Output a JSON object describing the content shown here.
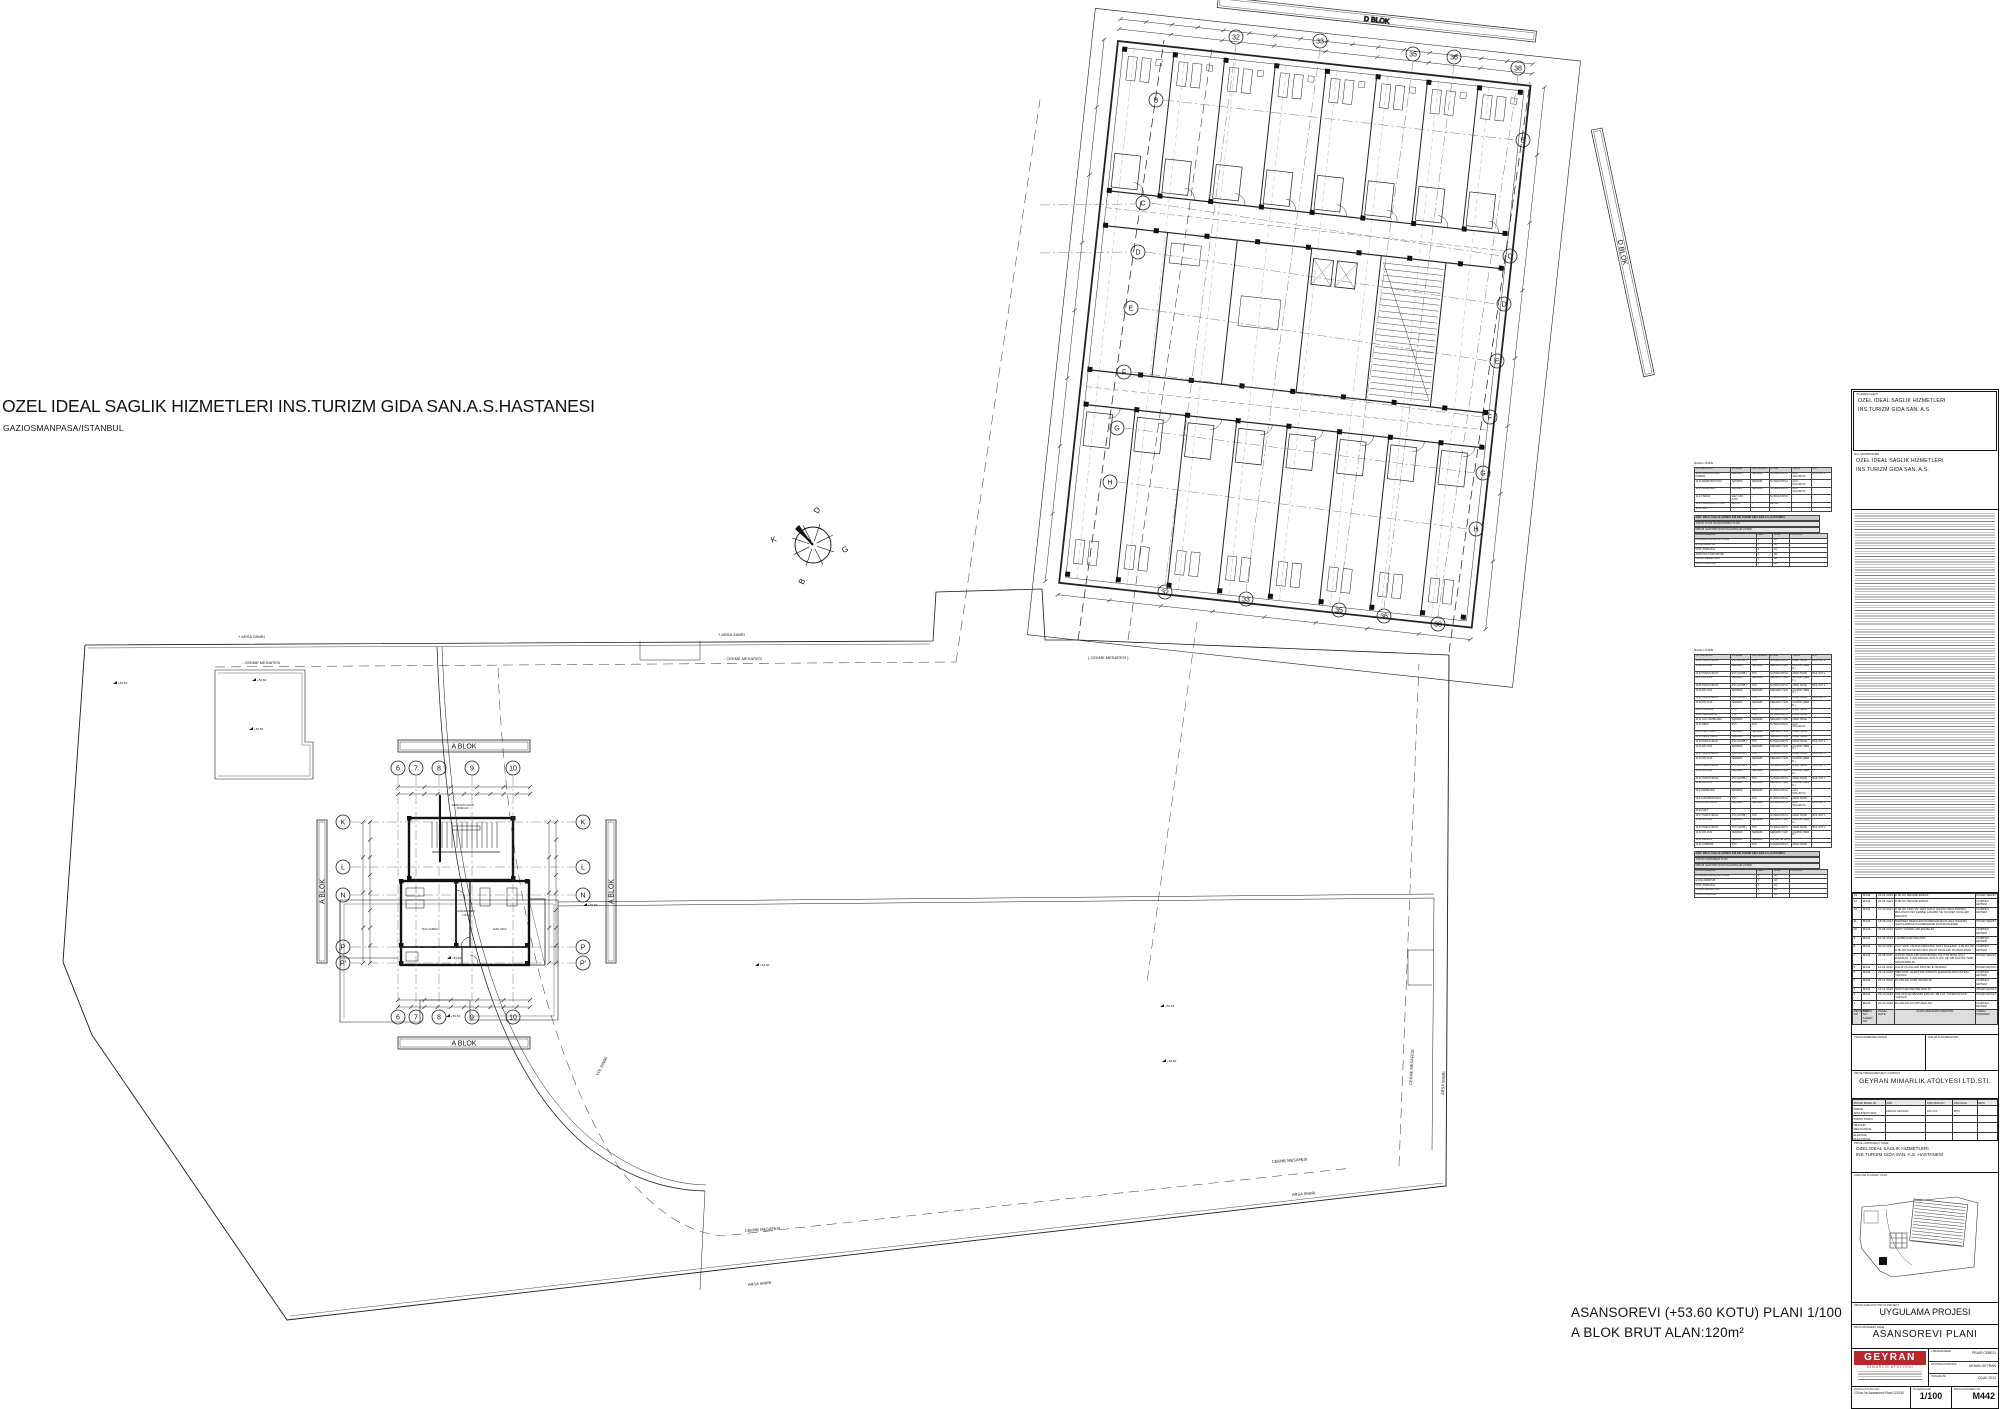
{
  "header": {
    "title": "OZEL IDEAL SAGLIK HIZMETLERI INS.TURIZM GIDA SAN.A.S.HASTANESI",
    "subtitle": "GAZIOSMANPASA/ISTANBUL"
  },
  "caption": {
    "line1": "ASANSOREVI (+53.60 KOTU) PLANI 1/100",
    "line2": "A BLOK BRUT ALAN:120m²"
  },
  "compass": {
    "top": "D",
    "left": "K",
    "right": "G",
    "bottom": "B"
  },
  "site_labels": [
    {
      "t": "+ ARSA SINIRI",
      "x": 238,
      "y": 638,
      "r": 0,
      "s": 4
    },
    {
      "t": "+ ARSA SINIRI",
      "x": 718,
      "y": 636,
      "r": 0,
      "s": 4
    },
    {
      "t": "- CEKME MESAFESI",
      "x": 242,
      "y": 664,
      "r": 0,
      "s": 4
    },
    {
      "t": "- CEKME MESAFESI",
      "x": 724,
      "y": 660,
      "r": 0,
      "s": 4
    },
    {
      "t": "( CEKME MESAFESI )",
      "x": 1088,
      "y": 659,
      "r": 0,
      "s": 4
    },
    {
      "t": "CEKME MESAFESI",
      "x": 745,
      "y": 1232,
      "r": -4,
      "s": 4
    },
    {
      "t": "ARSA SINIRI",
      "x": 748,
      "y": 1286,
      "r": -5,
      "s": 4
    },
    {
      "t": "CEKME MESAFESI",
      "x": 1272,
      "y": 1163,
      "r": -4,
      "s": 4
    },
    {
      "t": "ARSA SINIRI",
      "x": 1292,
      "y": 1196,
      "r": -4,
      "s": 4
    },
    {
      "t": "ARSA SINIRI",
      "x": 1444,
      "y": 1095,
      "r": -87,
      "s": 4
    },
    {
      "t": "CEKME MESAFESI",
      "x": 1412,
      "y": 1085,
      "r": -87,
      "s": 4
    },
    {
      "t": "YOL SINIRI",
      "x": 598,
      "y": 1076,
      "r": -62,
      "s": 4
    }
  ],
  "spot_value": "+53.60",
  "spots": [
    {
      "x": 113,
      "y": 684
    },
    {
      "x": 252,
      "y": 681
    },
    {
      "x": 249,
      "y": 730
    },
    {
      "x": 447,
      "y": 959
    },
    {
      "x": 446,
      "y": 1017
    },
    {
      "x": 583,
      "y": 906
    },
    {
      "x": 755,
      "y": 966
    },
    {
      "x": 1160,
      "y": 1007
    },
    {
      "x": 1162,
      "y": 1062
    }
  ],
  "a_block": {
    "bar_label": "A BLOK",
    "cols": {
      "labels": [
        "6",
        "7",
        "8",
        "9",
        "10"
      ],
      "x": [
        398,
        416,
        439,
        472,
        513
      ]
    },
    "rows": {
      "labels": [
        "K",
        "L",
        "N",
        "P",
        "P'"
      ],
      "y": [
        822,
        867,
        895,
        947,
        963
      ]
    },
    "top_y": 768,
    "bottom_y": 1017,
    "left_x": 343,
    "right_x": 583,
    "texts": [
      {
        "t": "MERDIVEN KOVASI",
        "x": 463,
        "y": 806,
        "s": 2.4
      },
      {
        "t": "BOSLUGU",
        "x": 463,
        "y": 809,
        "s": 2.4
      },
      {
        "t": "ASANSOREVI",
        "x": 466,
        "y": 912,
        "s": 2.8
      },
      {
        "t": "+53.60",
        "x": 466,
        "y": 916,
        "s": 2.5
      },
      {
        "t": "MAK. DAIRESI",
        "x": 430,
        "y": 930,
        "s": 2.3
      },
      {
        "t": "ELEK. PANO",
        "x": 500,
        "y": 930,
        "s": 2.3
      }
    ]
  },
  "d_block": {
    "bar_label": "D BLOK",
    "top": [
      {
        "t": "32",
        "x": 1236,
        "y": 37
      },
      {
        "t": "33",
        "x": 1320,
        "y": 41
      },
      {
        "t": "35",
        "x": 1413,
        "y": 54
      },
      {
        "t": "36",
        "x": 1454,
        "y": 57
      },
      {
        "t": "38",
        "x": 1518,
        "y": 68
      }
    ],
    "bottom": [
      {
        "t": "32",
        "x": 1165,
        "y": 592
      },
      {
        "t": "33",
        "x": 1246,
        "y": 599
      },
      {
        "t": "35",
        "x": 1339,
        "y": 610
      },
      {
        "t": "36",
        "x": 1384,
        "y": 616
      },
      {
        "t": "38",
        "x": 1438,
        "y": 624
      }
    ],
    "left": [
      {
        "t": "B",
        "x": 1156,
        "y": 100
      },
      {
        "t": "C",
        "x": 1143,
        "y": 203
      },
      {
        "t": "D",
        "x": 1138,
        "y": 252
      },
      {
        "t": "E",
        "x": 1131,
        "y": 308
      },
      {
        "t": "F",
        "x": 1124,
        "y": 372
      },
      {
        "t": "G",
        "x": 1117,
        "y": 428
      },
      {
        "t": "H",
        "x": 1110,
        "y": 482
      }
    ],
    "right": [
      {
        "t": "B",
        "x": 1523,
        "y": 140
      },
      {
        "t": "C",
        "x": 1510,
        "y": 256
      },
      {
        "t": "D",
        "x": 1504,
        "y": 304
      },
      {
        "t": "E",
        "x": 1497,
        "y": 361
      },
      {
        "t": "F",
        "x": 1490,
        "y": 417
      },
      {
        "t": "G",
        "x": 1483,
        "y": 473
      },
      {
        "t": "H",
        "x": 1476,
        "y": 529
      }
    ]
  },
  "tables": {
    "mahal_title": "MAHAL LISTESI",
    "mahal_cols": [
      "NO  MAHAL ADI",
      "DOSEME",
      "SUPURGELIK",
      "DUVAR",
      "TAVAN",
      "NOT"
    ],
    "mahal1_rows": [
      [
        "14.01 ASANSOR MAK. DAIRESI",
        "SERAMIK",
        "SERAMIK",
        "SU BAZLI BOYA",
        "ALCI SIVA+BOYA",
        "BKZ. NOT 2"
      ],
      [
        "14.02 MERDIVEN HOLU",
        "SERAMIK",
        "SERAMIK",
        "SU BAZLI BOYA",
        "ALCI SIVA+BOYA",
        "-"
      ],
      [
        "14.03 MERDIVEN",
        "SERAMIK",
        "SERAMIK",
        "SU BAZLI BOYA",
        "ALCI SIVA+BOYA",
        "-"
      ],
      [
        "14.04 TERAS",
        "GEZ. CATI KAPL.",
        "-",
        "SU BAZLI BOYA",
        "-",
        "-"
      ],
      [
        "14.05 ASANSOR KUYUSU",
        "BETON",
        "-",
        "BETON",
        "-",
        "-"
      ],
      [
        "14.06 SAFT",
        "-",
        "-",
        "-",
        "-",
        "-"
      ]
    ],
    "block1": {
      "line1": "OZEL IDEAL SAGLIK HIZMETLERI INS.TURIZM GIDA SAN.A.S. HASTANESI",
      "line2": "A BLOK 13.KAT VE ASANSOREVI PLANI",
      "line3": "MIMARI, ELEKTRIK DONATI ELEMANLARI LISTESI",
      "cols": [
        "DONATI ELEMANI",
        "ADET",
        "BIRIM",
        "ACIKLAMA"
      ],
      "rows": [
        [
          "FLORESAN ARMATUR 2X36W",
          "8",
          "AD",
          ""
        ],
        [
          "ETANJ ARMATUR",
          "4",
          "AD",
          ""
        ],
        [
          "PRIZ (TOPRAKLI)",
          "6",
          "AD",
          ""
        ],
        [
          "ANAHTAR (KOMUTATOR)",
          "4",
          "AD",
          ""
        ],
        [
          "DUMAN DEDEKTORU",
          "3",
          "AD",
          ""
        ],
        [
          "ACIL AYDINLATMA",
          "2",
          "AD",
          ""
        ]
      ]
    },
    "mahal2_rows": [
      [
        "13.01 HASTA ODASI",
        "PVC (ANTIB.)",
        "PVC",
        "SU BAZLI BOYA",
        "ASMA TAVAN",
        "BKZ. NOT 1"
      ],
      [
        "13.02 WC-DUS",
        "SERAMIK",
        "SERAMIK",
        "SERAMIK H:220",
        "ALCIPAN (NEM D.)",
        "-"
      ],
      [
        "13.03 HASTA ODASI",
        "PVC (ANTIB.)",
        "PVC",
        "SU BAZLI BOYA",
        "ASMA TAVAN",
        "BKZ. NOT 1"
      ],
      [
        "13.04 WC-DUS",
        "SERAMIK",
        "SERAMIK",
        "SERAMIK H:220",
        "ALCIPAN (NEM D.)",
        "-"
      ],
      [
        "13.05 HASTA ODASI",
        "PVC (ANTIB.)",
        "PVC",
        "SU BAZLI BOYA",
        "ASMA TAVAN",
        "BKZ. NOT 1"
      ],
      [
        "13.06 WC-DUS",
        "SERAMIK",
        "SERAMIK",
        "SERAMIK H:220",
        "ALCIPAN (NEM D.)",
        "-"
      ],
      [
        "13.07 HASTA ODASI",
        "PVC (ANTIB.)",
        "PVC",
        "SU BAZLI BOYA",
        "ASMA TAVAN",
        "BKZ. NOT 1"
      ],
      [
        "13.08 WC-DUS",
        "SERAMIK",
        "SERAMIK",
        "SERAMIK H:220",
        "ALCIPAN (NEM D.)",
        "-"
      ],
      [
        "13.09 KORIDOR",
        "PVC",
        "PVC",
        "SU BAZLI BOYA",
        "ASMA TAVAN",
        "-"
      ],
      [
        "13.10 HEMSIRE IST.",
        "PVC",
        "PVC",
        "SU BAZLI BOYA",
        "ASMA TAVAN",
        "-"
      ],
      [
        "13.11 ILAC HAZIRLAMA",
        "SERAMIK",
        "SERAMIK",
        "SERAMIK H:150",
        "ASMA TAVAN",
        "-"
      ],
      [
        "13.12 DEPO",
        "PVC",
        "PVC",
        "SU BAZLI BOYA",
        "ALCI SIVA+BOYA",
        "-"
      ],
      [
        "13.13 KIRLI ODASI",
        "SERAMIK",
        "SERAMIK",
        "SERAMIK H:220",
        "ASMA TAVAN",
        "-"
      ],
      [
        "13.14 TEMIZ ODASI",
        "SERAMIK",
        "SERAMIK",
        "SERAMIK H:220",
        "ASMA TAVAN",
        "-"
      ],
      [
        "13.15 HASTA ODASI",
        "PVC (ANTIB.)",
        "PVC",
        "SU BAZLI BOYA",
        "ASMA TAVAN",
        "BKZ. NOT 1"
      ],
      [
        "13.16 WC-DUS",
        "SERAMIK",
        "SERAMIK",
        "SERAMIK H:220",
        "ALCIPAN (NEM D.)",
        "-"
      ],
      [
        "13.17 HASTA ODASI",
        "PVC (ANTIB.)",
        "PVC",
        "SU BAZLI BOYA",
        "ASMA TAVAN",
        "BKZ. NOT 1"
      ],
      [
        "13.18 WC-DUS",
        "SERAMIK",
        "SERAMIK",
        "SERAMIK H:220",
        "ALCIPAN (NEM D.)",
        "-"
      ],
      [
        "13.19 HASTA ODASI",
        "PVC (ANTIB.)",
        "PVC",
        "SU BAZLI BOYA",
        "ASMA TAVAN",
        "BKZ. NOT 1"
      ],
      [
        "13.20 WC-DUS",
        "SERAMIK",
        "SERAMIK",
        "SERAMIK H:220",
        "ALCIPAN (NEM D.)",
        "-"
      ],
      [
        "13.21 HASTA ODASI",
        "PVC (ANTIB.)",
        "PVC",
        "SU BAZLI BOYA",
        "ASMA TAVAN",
        "BKZ. NOT 1"
      ],
      [
        "13.22 WC-DUS",
        "SERAMIK",
        "SERAMIK",
        "SERAMIK H:220",
        "ALCIPAN (NEM D.)",
        "-"
      ],
      [
        "13.23 MERDIVEN",
        "SERAMIK",
        "SERAMIK",
        "SU BAZLI BOYA",
        "ALCI SIVA+BOYA",
        "-"
      ],
      [
        "13.24 ASANSOR HOLU",
        "PVC",
        "PVC",
        "SU BAZLI BOYA",
        "ASMA TAVAN",
        "-"
      ],
      [
        "13.25 PANO ODASI",
        "SERAMIK",
        "SERAMIK",
        "SU BAZLI BOYA",
        "ALCI SIVA+BOYA",
        "BKZ. NOT 2"
      ],
      [
        "13.26 SAFT",
        "-",
        "-",
        "-",
        "-",
        "-"
      ],
      [
        "13.27 HASTA ODASI",
        "PVC (ANTIB.)",
        "PVC",
        "SU BAZLI BOYA",
        "ASMA TAVAN",
        "BKZ. NOT 1"
      ],
      [
        "13.28 WC-DUS",
        "SERAMIK",
        "SERAMIK",
        "SERAMIK H:220",
        "ALCIPAN (NEM D.)",
        "-"
      ],
      [
        "13.29 HASTA ODASI",
        "PVC (ANTIB.)",
        "PVC",
        "SU BAZLI BOYA",
        "ASMA TAVAN",
        "BKZ. NOT 1"
      ],
      [
        "13.30 WC-DUS",
        "SERAMIK",
        "SERAMIK",
        "SERAMIK H:220",
        "ALCIPAN (NEM D.)",
        "-"
      ],
      [
        "13.31 BALKON",
        "SERAMIK",
        "SERAMIK",
        "DIS CEPHE BOYA",
        "-",
        "-"
      ],
      [
        "13.32 KORIDOR",
        "PVC",
        "PVC",
        "SU BAZLI BOYA",
        "ASMA TAVAN",
        "-"
      ]
    ],
    "block2": {
      "line1": "OZEL IDEAL SAGLIK HIZMETLERI INS.TURIZM GIDA SAN.A.S. HASTANESI",
      "line2": "A BLOK ASANSOREVI PLANI",
      "line3": "MIMARI, ELEKTRIK DONATI ELEMANLARI LISTESI",
      "cols": [
        "DONATI ELEMANI",
        "ADET",
        "BIRIM",
        "ACIKLAMA"
      ],
      "rows": [
        [
          "FLORESAN ARMATUR 1X36W",
          "6",
          "AD",
          ""
        ],
        [
          "ETANJ ARMATUR",
          "3",
          "AD",
          ""
        ],
        [
          "PRIZ (TOPRAKLI)",
          "4",
          "AD",
          ""
        ],
        [
          "DUMAN DEDEKTORU",
          "2",
          "AD",
          ""
        ],
        [
          "ACIL AYDINLATMA",
          "2",
          "AD",
          ""
        ]
      ]
    }
  },
  "titleblock": {
    "client_label": "IS VEREN/CLIENT",
    "client_line1": "OZEL IDEAL SAGLIK HIZMETLERI",
    "client_line2": "INS.TURIZM GIDA SAN. A.S.",
    "owner_label": "MAL SAHIBI/OWNER",
    "owner_line1": "OZEL IDEAL SAGLIK HIZMETLERI",
    "owner_line2": "INS.TURIZM GIDA SAN. A.S.",
    "revision": {
      "headers": [
        "REVIZYON NO",
        "PAFTA NO. SHEET NO",
        "TARIH DATE",
        "ACIKLAMA EXPLANATION",
        "CIZEN DRAWER"
      ],
      "rows": [
        [
          "14",
          "M442",
          "24.01.2013",
          "D BLOK REVIZE EDILDI.",
          "PINAR SERIN"
        ],
        [
          "13",
          "M442",
          "24.01.2013",
          "D BLOK REVIZE EDILDI.",
          "NURTEN ERTEM"
        ],
        [
          "12",
          "M442",
          "17.10.2012",
          "D BLOK 1302 VE 1303 NOLU HASTA ODALARINDA BULUNAN WC'LERDE LAVABO VE KLOZET AKSLARI DEGISTI.",
          "NURTEN ERTEM"
        ],
        [
          "11",
          "M442",
          "18.09.2012",
          "DEPREM DERZLERI DUZENLENDI PLANA ISLENDI. SAFTLARDAKI DUZENLEME PLANA ISLENDI.",
          "PINAR SERIN"
        ],
        [
          "10",
          "M442",
          "24.05.2012",
          "SAFT KAPAKLARI DUZELDI.",
          "NURTEN ERTEM"
        ],
        [
          "9",
          "M442",
          "10.04.2012",
          "LAVABOLAR DEGISTI.",
          "NURTEN ERTEM"
        ],
        [
          "8",
          "M442",
          "20.12.2011",
          "22-P AKSI YANINA MEKANIK SAFT EKLENDI. A BLOK VE D BLOKTAKI ELEKTRIK PANO ODALARI DUZENLENDI.",
          "NURTEN ERTEM"
        ],
        [
          "7",
          "M442",
          "24.08.2011",
          "HASTA ODALARI DUVARINDA YALITIM BOSLUGU DARALDI. 1.220 MAHAL NO'LU WC VE DB SAFTIN YERI DEGISTIRILDI.",
          "PINAR SERIN"
        ],
        [
          "6",
          "M442",
          "10.01.2011",
          "KALIP PLANLARI PROJEYE ISLENDI.",
          "PINAR EKINCI"
        ],
        [
          "5",
          "M442",
          "23.12.2010",
          "MEKANIK, ELEKTRIK DONATI ELEMANLARI LISTESI YAPILDI.",
          "NURTEN ERTEM"
        ],
        [
          "4",
          "M442",
          "25.11.2010",
          "PLANLAR 1/100 CEVRILDI.",
          "NURTEN ERTEM"
        ],
        [
          "3",
          "M442",
          "16.11.2010",
          "SAFTLAR REVIZE EDILDI.",
          "PINAR EKINCI"
        ],
        [
          "2",
          "M223",
          "25.10.2010",
          "KOLONLAR REVIZE EDILDI. 3B KAT YONETIM KATI YAPILDI.",
          "PINAR EKINCI"
        ],
        [
          "1",
          "M223",
          "20.10.2010",
          "PLANLAR OLUSTURULDU.",
          "NURTEN ERTEM"
        ]
      ]
    },
    "teslim_eden": "TESLIM EDEN/DELIVERER",
    "teslim_alan": "TESLIM ALAN/RECEIVER",
    "company_label": "PROJE FIRMASI/PROJECT COMPANY",
    "company_name": "GEYRAN MIMARLIK ATOLYESI LTD.STI.",
    "sig": {
      "cols": [
        "PROJE MUELLIFI",
        "ISIM",
        "DIPLOMA NO",
        "ODA SICIL",
        "IMZA"
      ],
      "rows": [
        [
          "MIMAR ARCHITECTURAL",
          "KENAN GEYRAN",
          "100-710",
          "6872",
          ""
        ],
        [
          "STATIK STATIC",
          "",
          "",
          "",
          ""
        ],
        [
          "MEKANIK MECHANICAL",
          "",
          "",
          "",
          ""
        ],
        [
          "ELEKTRIK ELECTRICAL",
          "",
          "",
          "",
          ""
        ]
      ]
    },
    "project_label": "PROJE ADI/PROJECT NAME",
    "project_line1": "OZEL IDEAL SAGLIK HIZMETLERI",
    "project_line2": "INS.TURIZM GIDA SAN. A.S. HASTANESI",
    "keyplan_label": "ANAHTAR PLAN/KEY PLAN",
    "phase_label": "PROJE SAFHASI/TYPE OF PROJECT",
    "phase_value": "UYGULAMA PROJESI",
    "sheetname_label": "PAFTA ADI/SHEET NAME",
    "sheetname_value": "ASANSOREVI  PLANI",
    "logo_name": "GEYRAN",
    "logo_sub": "MIMARLIK  ATOLYESI",
    "drawer_label": "CIZEN/DRAWER",
    "drawer_value": "PINAR CEBECI",
    "control_label": "KONTROL/CONTROL",
    "control_value": "KENAN GEYRAN",
    "date_label": "TARIH/DATE",
    "date_value": "OCAK 2013",
    "file_label": "DOSYA KUTUGU NO:",
    "file_value": "13.Kat Ve Asansorevi Plani 120130",
    "scale_label": "OLCEK/SCALE",
    "scale_value": "1/100",
    "sheet_label": "PAFTA NO/SHEET NO",
    "sheet_value": "M442"
  }
}
